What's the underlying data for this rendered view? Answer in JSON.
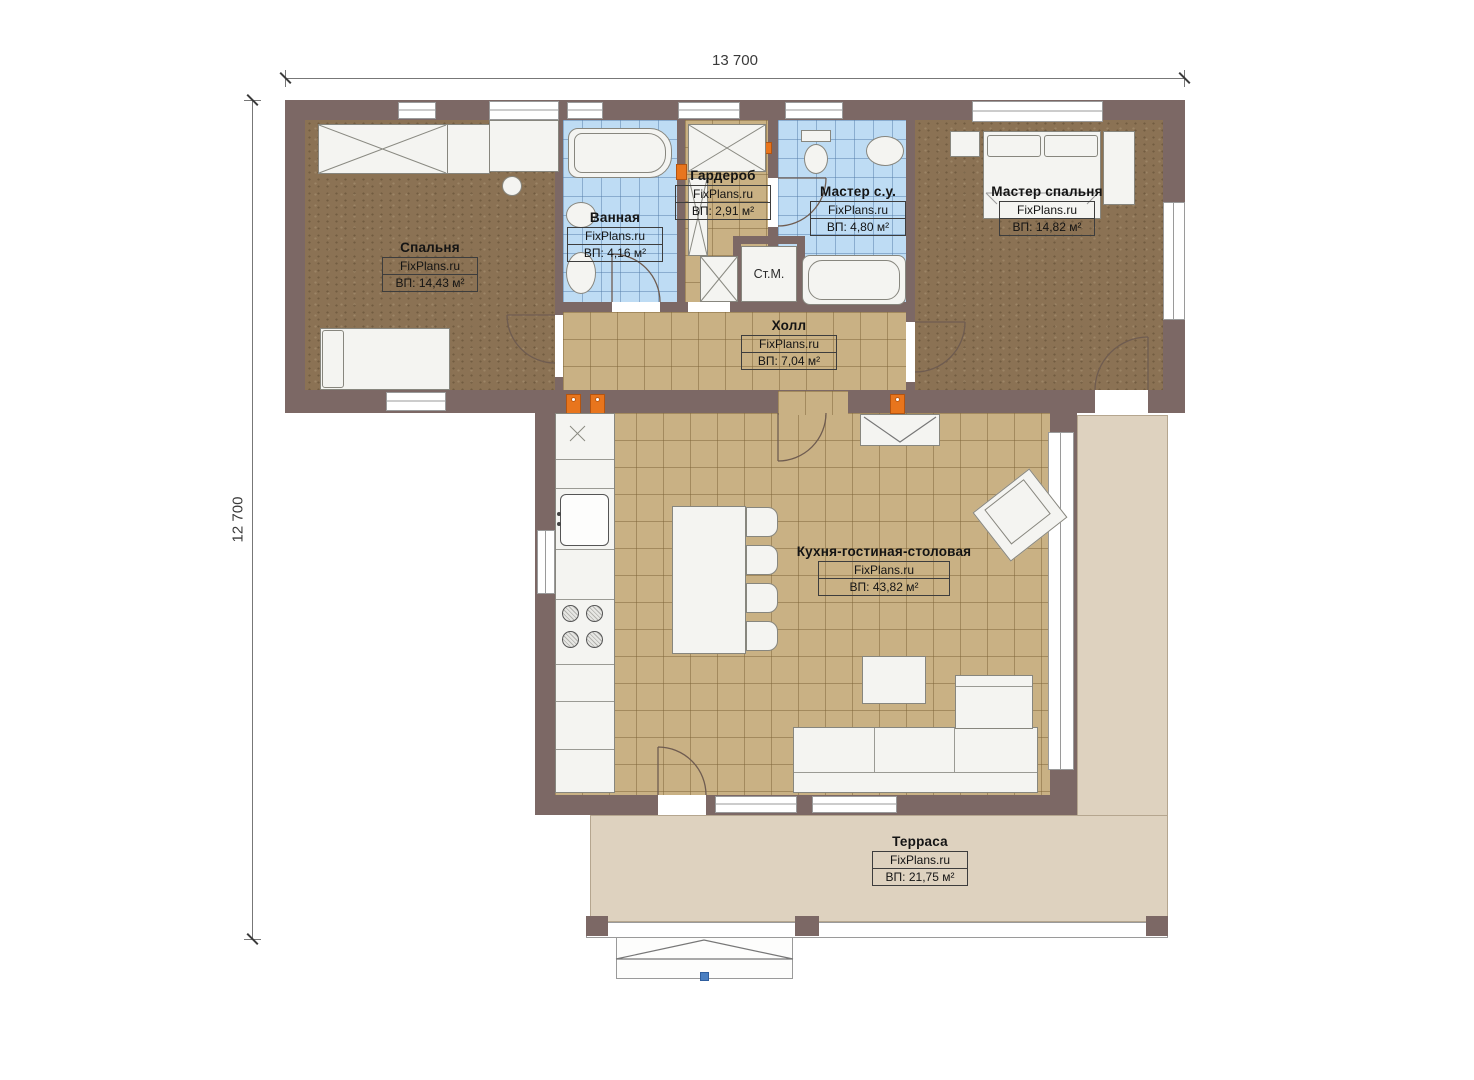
{
  "dimensions": {
    "width_label": "13 700",
    "height_label": "12 700"
  },
  "rooms": [
    {
      "key": "bedroom",
      "name": "Спальня",
      "brand": "FixPlans.ru",
      "area": "ВП: 14,43 м²"
    },
    {
      "key": "bathroom",
      "name": "Ванная",
      "brand": "FixPlans.ru",
      "area": "ВП: 4,16 м²"
    },
    {
      "key": "wardrobe",
      "name": "Гардероб",
      "brand": "FixPlans.ru",
      "area": "ВП: 2,91 м²"
    },
    {
      "key": "master_bath",
      "name": "Мастер с.у.",
      "brand": "FixPlans.ru",
      "area": "ВП: 4,80 м²"
    },
    {
      "key": "master_bedroom",
      "name": "Мастер спальня",
      "brand": "FixPlans.ru",
      "area": "ВП: 14,82 м²"
    },
    {
      "key": "hall",
      "name": "Холл",
      "brand": "FixPlans.ru",
      "area": "ВП: 7,04 м²"
    },
    {
      "key": "kitchen_living",
      "name": "Кухня-гостиная-столовая",
      "brand": "FixPlans.ru",
      "area": "ВП: 43,82 м²"
    },
    {
      "key": "terrace",
      "name": "Терраса",
      "brand": "FixPlans.ru",
      "area": "ВП: 21,75 м²"
    }
  ],
  "fixtures": {
    "washing_machine": "Ст.М."
  },
  "colors": {
    "wall": "#7c6865",
    "wood_floor": "#8b7254",
    "tile_floor": "#c9b184",
    "bath_tile": "#bedcf4",
    "terrace": "#ded2bf",
    "accent_orange": "#e8751d",
    "marker_blue": "#4a7fc1"
  }
}
